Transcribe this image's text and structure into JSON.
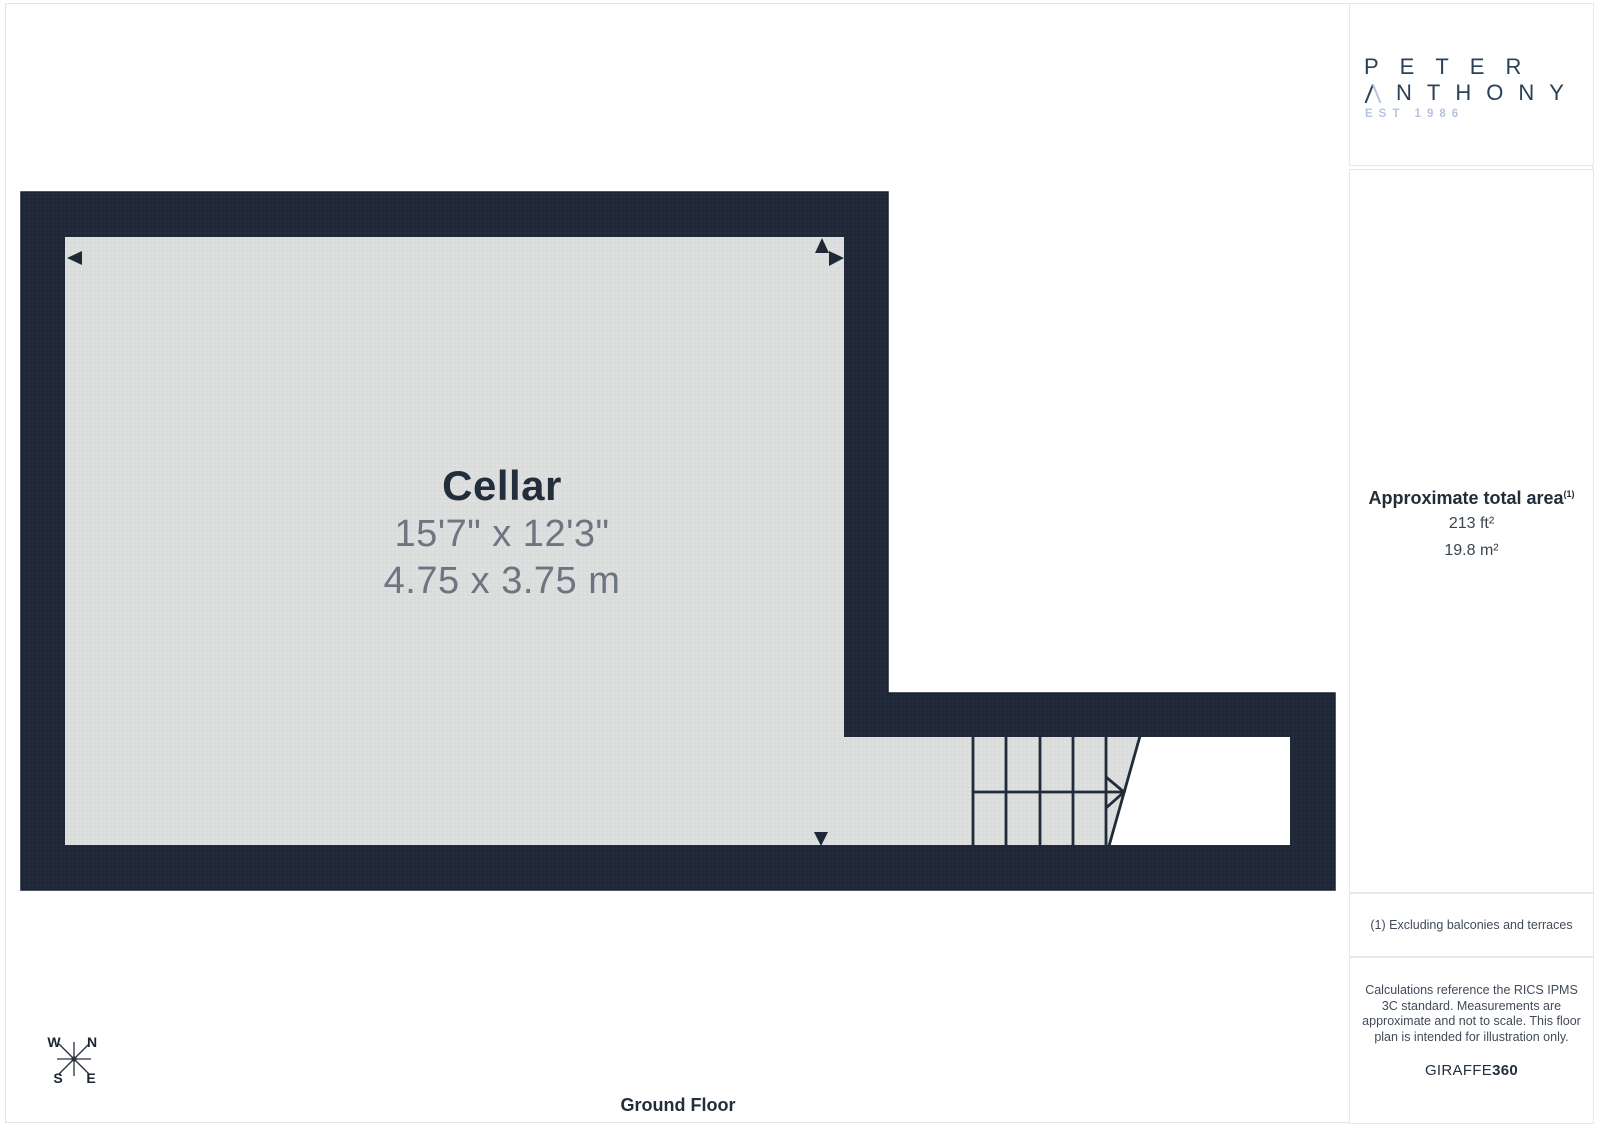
{
  "brand": {
    "name_line1": "PETER",
    "name_line2_rest": "NTHONY",
    "established": "EST 1986"
  },
  "plan": {
    "room": {
      "name": "Cellar",
      "dimensions_imperial": "15'7\" x 12'3\"",
      "dimensions_metric": "4.75 x 3.75 m"
    },
    "floor_label": "Ground Floor",
    "compass": {
      "north": "N",
      "east": "E",
      "south": "S",
      "west": "W"
    }
  },
  "sidebar": {
    "area": {
      "heading": "Approximate total area",
      "footnote_marker": "(1)",
      "imperial": "213 ft²",
      "metric": "19.8 m²"
    },
    "footnote": "(1) Excluding balconies and terraces",
    "disclaimer": "Calculations reference the RICS IPMS 3C standard. Measurements are approximate and not to scale. This floor plan is intended for illustration only.",
    "credit_name": "GIRAFFE",
    "credit_suffix": "360"
  },
  "colors": {
    "wall": "#1e2836",
    "wall_dot": "#2c3849",
    "floor": "#dbdcdc",
    "floor_dot": "#e9eae9",
    "line_dark": "#212c3a",
    "logo_navy": "#2b4156",
    "logo_light_blue": "#b7c4e0",
    "text_dark": "#232e3c",
    "text_gray": "#6d7580",
    "border_light": "#e8e8e8"
  }
}
